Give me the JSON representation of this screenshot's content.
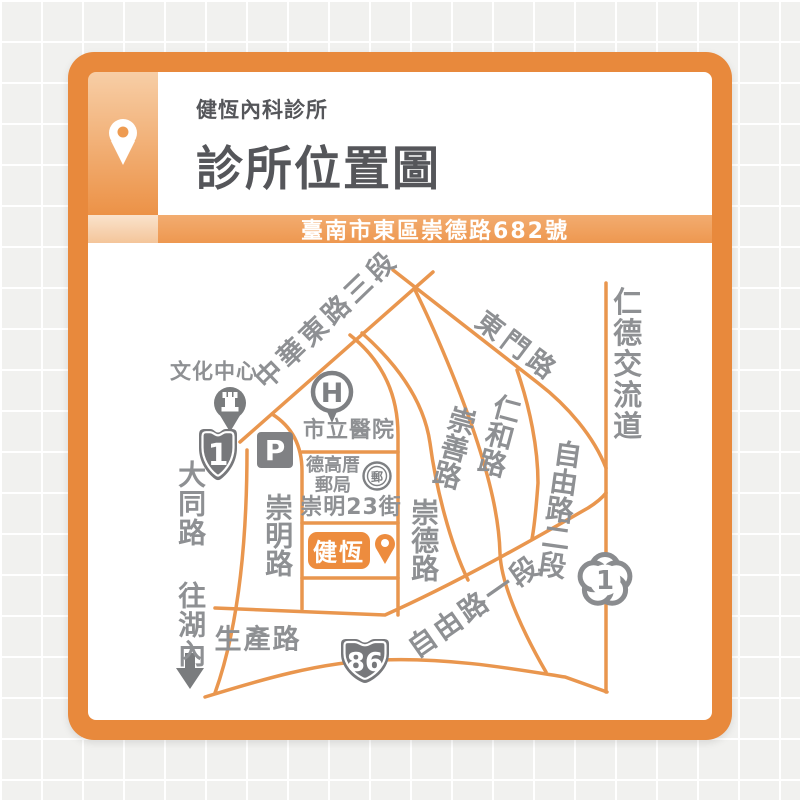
{
  "header": {
    "clinic_name": "健恆內科診所",
    "title": "診所位置圖"
  },
  "address_bar": {
    "address": "臺南市東區崇德路682號"
  },
  "map": {
    "roads": {
      "zhonghua": "中華東路三段",
      "dongmen": "東門路",
      "rende": "仁德交流道",
      "datong": "大同路 往湖內",
      "chongming": "崇明路",
      "chongde": "崇德路",
      "chongshan": "崇善路",
      "renhe": "仁和路",
      "ziyou2": "自由路二段",
      "ziyou1": "自由路一段",
      "shengchan": "生產路",
      "chongming23": "崇明23街"
    },
    "pois": {
      "cultural_center": "文化中心",
      "city_hospital": "市立醫院",
      "hospital_letter": "H",
      "parking": "P",
      "post_office_line1": "德高厝",
      "post_office_line2": "郵局",
      "post_office_emblem": "郵",
      "clinic": "健恆"
    },
    "route_markers": {
      "provincial": "1",
      "expressway": "86",
      "freeway": "1"
    }
  },
  "colors": {
    "frame_orange": "#E8893C",
    "road_orange": "#E9964E",
    "clinic_box_orange": "#ED8C3E",
    "label_gray": "#8E9093",
    "icon_gray": "#7A7C7E",
    "title_gray": "#55565A"
  }
}
